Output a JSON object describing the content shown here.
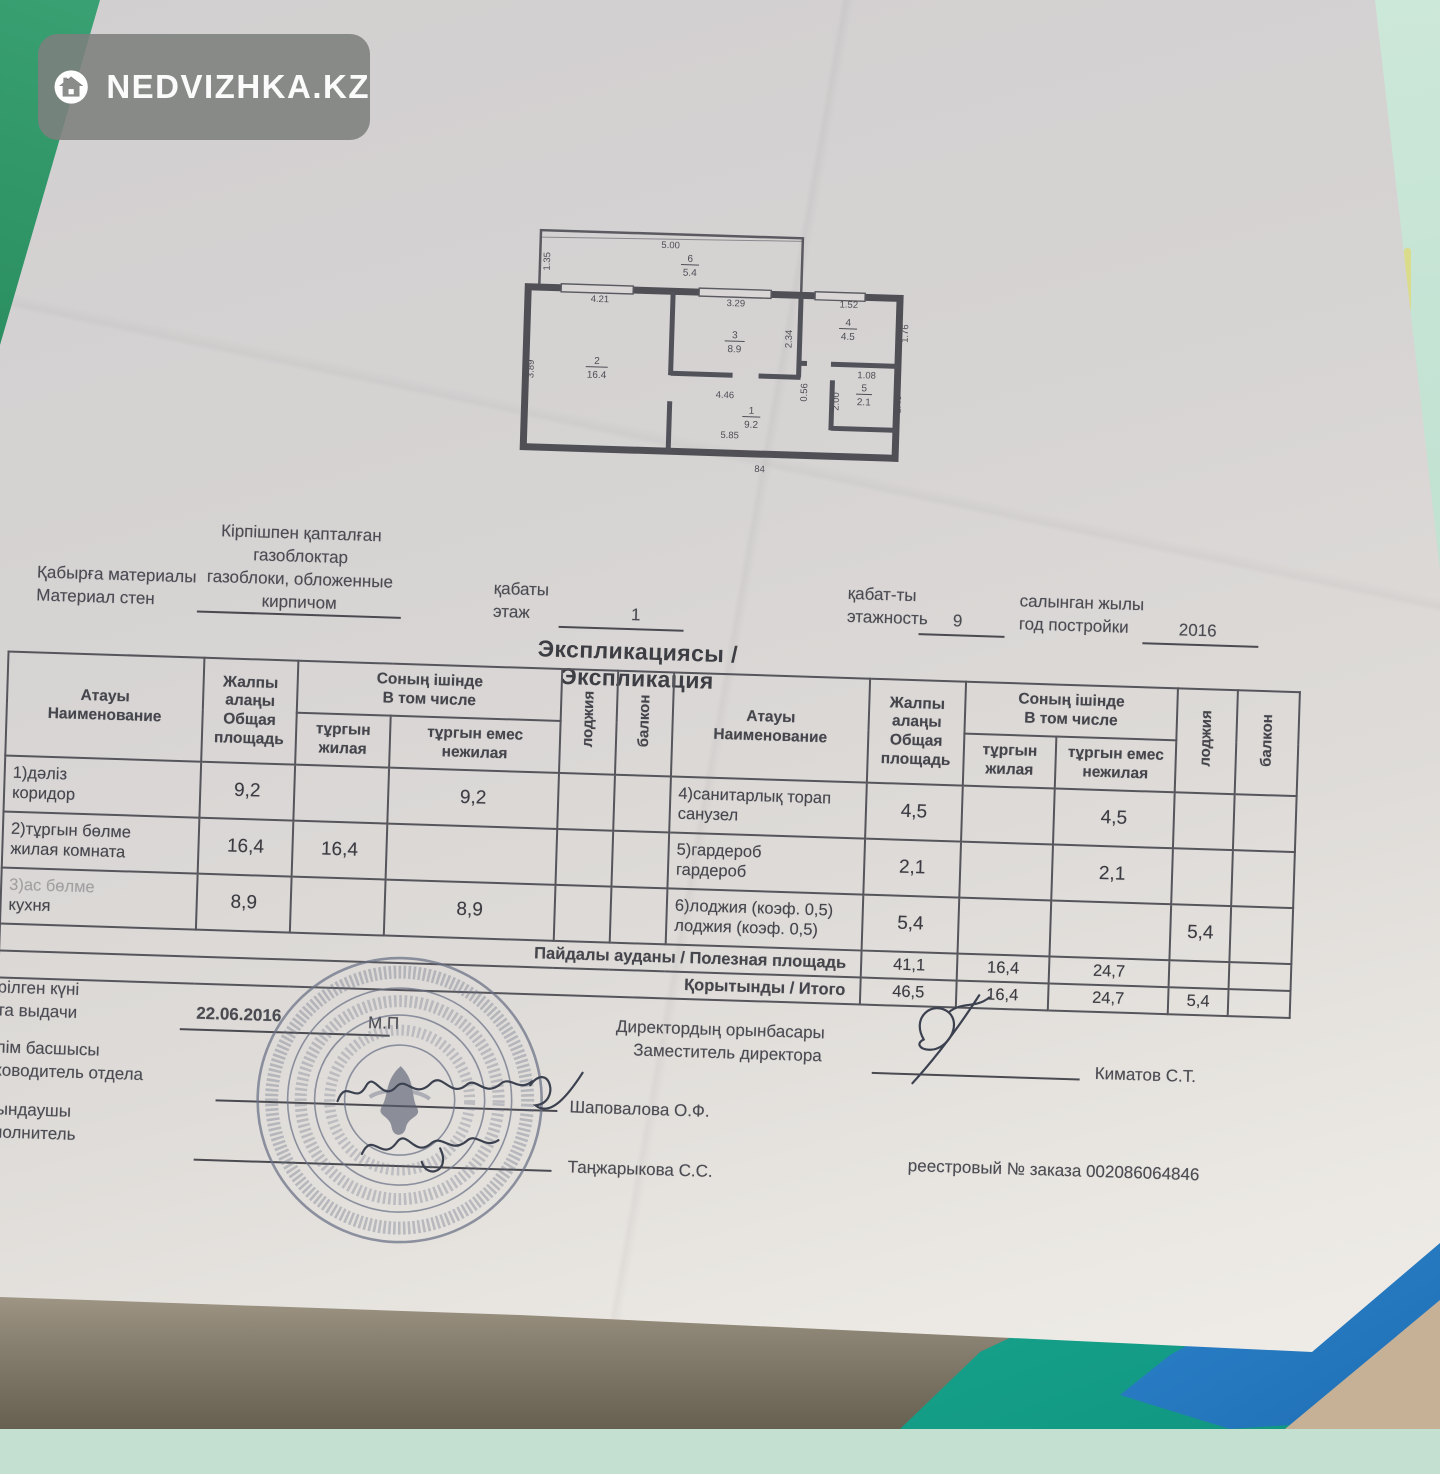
{
  "watermark": {
    "brand": "NEDVIZHKA.KZ"
  },
  "floor_plan": {
    "rooms": [
      {
        "num": "1",
        "area": "9.2"
      },
      {
        "num": "2",
        "area": "16.4"
      },
      {
        "num": "3",
        "area": "8.9"
      },
      {
        "num": "4",
        "area": "4.5"
      },
      {
        "num": "5",
        "area": "2.1"
      },
      {
        "num": "6",
        "area": "5.4"
      }
    ],
    "dims": {
      "loggia_width": "5.00",
      "loggia_depth": "1.35",
      "room2_width": "4.21",
      "room2_depth": "3.89",
      "room3_width": "3.29",
      "room3_depth": "2.34",
      "room4_width": "1.52",
      "room4_depth": "1.76",
      "hall_width": "4.46",
      "hall_length": "5.85",
      "door_mark": "84",
      "d_056": "0.56",
      "d_200": "2.00",
      "d_108": "1.08",
      "d_149": "1.49"
    }
  },
  "header": {
    "wall_label_kk": "Қабырға материалы",
    "wall_label_ru": "Материал стен",
    "wall_value_lines": [
      "Кірпішпен қапталған",
      "газоблоктар",
      "газоблоки, обложенные",
      "кирпичом"
    ],
    "floor_label_kk": "қабаты",
    "floor_label_ru": "этаж",
    "floor_value": "1",
    "floors_label_kk": "қабат-ты",
    "floors_label_ru": "этажность",
    "floors_value": "9",
    "year_label_kk": "салынган жылы",
    "year_label_ru": "год постройки",
    "year_value": "2016"
  },
  "title": "Экспликациясы / Экспликация",
  "table": {
    "head": {
      "name_kk": "Атауы",
      "name_ru": "Наименование",
      "total_kk": "Жалпы алаңы",
      "total_ru": "Общая площадь",
      "incl_kk": "Соның ішінде",
      "incl_ru": "В том числе",
      "living_kk": "тұргын",
      "living_ru": "жилая",
      "nonliving_kk": "тұргын емес",
      "nonliving_ru": "нежилая",
      "loggia": "лоджия",
      "balcony": "балкон"
    },
    "rows_left": [
      {
        "name_kk": "1)дәліз",
        "name_ru": "коридор",
        "total": "9,2",
        "living": "",
        "nonliving": "9,2",
        "loggia": "",
        "balcony": ""
      },
      {
        "name_kk": "2)тұргын бөлме",
        "name_ru": "жилая комната",
        "total": "16,4",
        "living": "16,4",
        "nonliving": "",
        "loggia": "",
        "balcony": ""
      },
      {
        "name_kk": "3)ас бөлме",
        "name_ru": "кухня",
        "total": "8,9",
        "living": "",
        "nonliving": "8,9",
        "loggia": "",
        "balcony": ""
      }
    ],
    "rows_right": [
      {
        "name_kk": "4)санитарлық торап",
        "name_ru": "санузел",
        "total": "4,5",
        "living": "",
        "nonliving": "4,5",
        "loggia": "",
        "balcony": ""
      },
      {
        "name_kk": "5)гардероб",
        "name_ru": "гардероб",
        "total": "2,1",
        "living": "",
        "nonliving": "2,1",
        "loggia": "",
        "balcony": ""
      },
      {
        "name_kk": "6)лоджия (коэф. 0,5)",
        "name_ru": "лоджия (коэф. 0,5)",
        "total": "5,4",
        "living": "",
        "nonliving": "",
        "loggia": "5,4",
        "balcony": ""
      }
    ],
    "totals": [
      {
        "label": "Пайдалы ауданы / Полезная площадь",
        "total": "41,1",
        "living": "16,4",
        "nonliving": "24,7",
        "loggia": "",
        "balcony": ""
      },
      {
        "label": "Қорытынды / Итого",
        "total": "46,5",
        "living": "16,4",
        "nonliving": "24,7",
        "loggia": "5,4",
        "balcony": ""
      }
    ]
  },
  "footer": {
    "issued_kk": "Берілген күні",
    "issued_ru": "Дата выдачи",
    "issue_date": "22.06.2016",
    "stamp_mark": "М.П",
    "dept_head_kk": "Бөлім басшысы",
    "dept_head_ru": "Руководитель отдела",
    "dept_head_name": "Шаповалова О.Ф.",
    "executor_kk": "Орындаушы",
    "executor_ru": "Исполнитель",
    "executor_name": "Таңжарыкова С.С.",
    "deputy_kk": "Директордың орынбасары",
    "deputy_ru": "Заместитель директора",
    "deputy_name": "Киматов С.Т.",
    "registry": "реестровый № заказа 002086064846"
  }
}
